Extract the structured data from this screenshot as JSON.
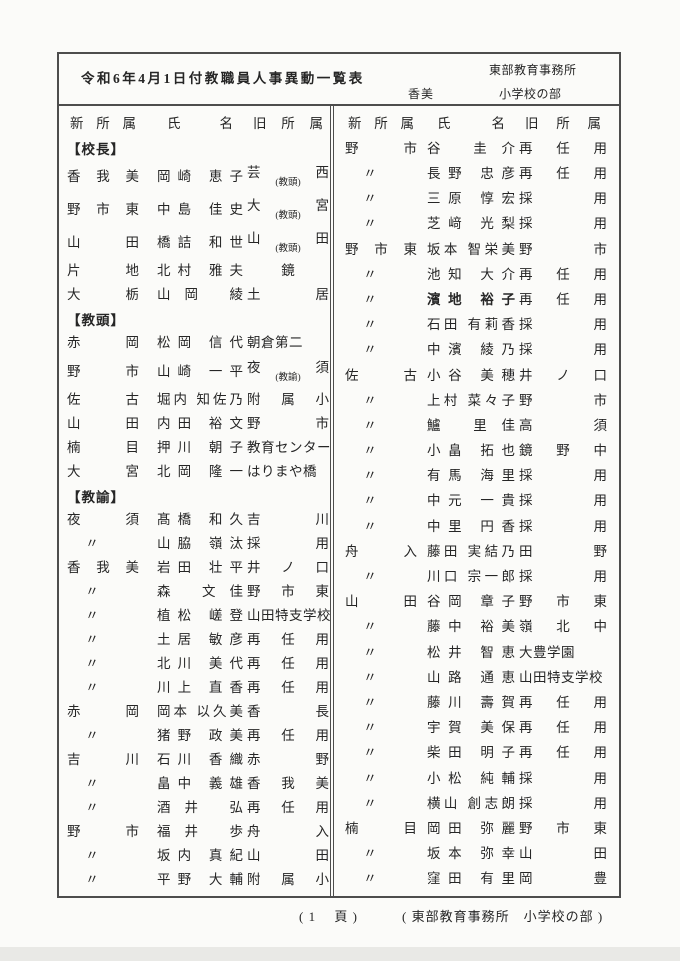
{
  "page": {
    "title": "令和6年4月1日付教職員人事異動一覧表",
    "office": "東部教育事務所",
    "region": "香美",
    "section": "小学校の部",
    "footer": {
      "page_label": "( 1　 頁 )",
      "office_label": "( 東部教育事務所　小学校の部 )"
    }
  },
  "colors": {
    "paper": "#fbfbf9",
    "ink": "#262626",
    "border": "#4d4d4d"
  },
  "table": {
    "headers": [
      "新所属",
      "氏名",
      "旧所属"
    ],
    "left": [
      {
        "section": "【校長】"
      },
      {
        "new": "香我美",
        "name": "岡崎 恵子",
        "old": "芸西",
        "old_note": "(教頭)"
      },
      {
        "new": "野市東",
        "name": "中島 佳史",
        "old": "大宮",
        "old_note": "(教頭)"
      },
      {
        "new": "山田",
        "name": "橋詰 和世",
        "old": "山田",
        "old_note": "(教頭)"
      },
      {
        "new": "片地",
        "name": "北村 雅夫",
        "old": "鏡"
      },
      {
        "new": "大栃",
        "name": "山岡 綾",
        "old": "土居"
      },
      {
        "section": "【教頭】"
      },
      {
        "new": "赤岡",
        "name": "松岡 信代",
        "old": "朝倉第二"
      },
      {
        "new": "野市",
        "name": "山崎 一平",
        "old": "夜須",
        "old_note": "(教諭)"
      },
      {
        "new": "佐古",
        "name": "堀内 知佐乃",
        "old": "附属小"
      },
      {
        "new": "山田",
        "name": "内田 裕文",
        "old": "野市"
      },
      {
        "new": "楠目",
        "name": "押川 朝子",
        "old": "教育センター"
      },
      {
        "new": "大宮",
        "name": "北岡 隆一",
        "old": "はりまや橋"
      },
      {
        "section": "【教諭】"
      },
      {
        "new": "夜須",
        "name": "髙橋 和久",
        "old": "吉川"
      },
      {
        "new": "〃",
        "name": "山脇 嶺汰",
        "old": "採用"
      },
      {
        "new": "香我美",
        "name": "岩田 壮平",
        "old": "井ノ口"
      },
      {
        "new": "〃",
        "name": "森 文佳",
        "old": "野市東"
      },
      {
        "new": "〃",
        "name": "植松 嵯登",
        "old": "山田特支学校"
      },
      {
        "new": "〃",
        "name": "土居 敏彦",
        "old": "再任用"
      },
      {
        "new": "〃",
        "name": "北川 美代",
        "old": "再任用"
      },
      {
        "new": "〃",
        "name": "川上 直香",
        "old": "再任用"
      },
      {
        "new": "赤岡",
        "name": "岡本 以久美",
        "old": "香長"
      },
      {
        "new": "〃",
        "name": "猪野 政美",
        "old": "再任用"
      },
      {
        "new": "吉川",
        "name": "石川 香織",
        "old": "赤野"
      },
      {
        "new": "〃",
        "name": "畠中 義雄",
        "old": "香我美"
      },
      {
        "new": "〃",
        "name": "酒井 弘",
        "old": "再任用"
      },
      {
        "new": "野市",
        "name": "福井 歩",
        "old": "舟入"
      },
      {
        "new": "〃",
        "name": "坂内 真紀",
        "old": "山田"
      },
      {
        "new": "〃",
        "name": "平野 大輔",
        "old": "附属小"
      }
    ],
    "right": [
      {
        "new": "野市",
        "name": "谷 圭介",
        "old": "再任用"
      },
      {
        "new": "〃",
        "name": "長野 忠彦",
        "old": "再任用"
      },
      {
        "new": "〃",
        "name": "三原 惇宏",
        "old": "採用"
      },
      {
        "new": "〃",
        "name": "芝﨑 光梨",
        "old": "採用"
      },
      {
        "new": "野市東",
        "name": "坂本 智栄美",
        "old": "野市"
      },
      {
        "new": "〃",
        "name": "池知 大介",
        "old": "再任用"
      },
      {
        "new": "〃",
        "name": "濱地 裕子",
        "old": "再任用",
        "bold": true
      },
      {
        "new": "〃",
        "name": "石田 有莉香",
        "old": "採用"
      },
      {
        "new": "〃",
        "name": "中濱 綾乃",
        "old": "採用"
      },
      {
        "new": "佐古",
        "name": "小谷 美穂",
        "old": "井ノ口"
      },
      {
        "new": "〃",
        "name": "上村 菜々子",
        "old": "野市"
      },
      {
        "new": "〃",
        "name": "鱸 里佳",
        "old": "高須"
      },
      {
        "new": "〃",
        "name": "小畠 拓也",
        "old": "鏡野中"
      },
      {
        "new": "〃",
        "name": "有馬 海里",
        "old": "採用"
      },
      {
        "new": "〃",
        "name": "中元 一貴",
        "old": "採用"
      },
      {
        "new": "〃",
        "name": "中里 円香",
        "old": "採用"
      },
      {
        "new": "舟入",
        "name": "藤田 実結乃",
        "old": "田野"
      },
      {
        "new": "〃",
        "name": "川口 宗一郎",
        "old": "採用"
      },
      {
        "new": "山田",
        "name": "谷岡 章子",
        "old": "野市東"
      },
      {
        "new": "〃",
        "name": "藤中 裕美",
        "old": "嶺北中"
      },
      {
        "new": "〃",
        "name": "松井 智恵",
        "old": "大豊学園"
      },
      {
        "new": "〃",
        "name": "山路 通恵",
        "old": "山田特支学校"
      },
      {
        "new": "〃",
        "name": "藤川 壽賀",
        "old": "再任用"
      },
      {
        "new": "〃",
        "name": "宇賀 美保",
        "old": "再任用"
      },
      {
        "new": "〃",
        "name": "柴田 明子",
        "old": "再任用"
      },
      {
        "new": "〃",
        "name": "小松 純輔",
        "old": "採用"
      },
      {
        "new": "〃",
        "name": "横山 創志朗",
        "old": "採用"
      },
      {
        "new": "楠目",
        "name": "岡田 弥麗",
        "old": "野市東"
      },
      {
        "new": "〃",
        "name": "坂本 弥幸",
        "old": "山田"
      },
      {
        "new": "〃",
        "name": "窪田 有里",
        "old": "岡豊"
      }
    ]
  }
}
